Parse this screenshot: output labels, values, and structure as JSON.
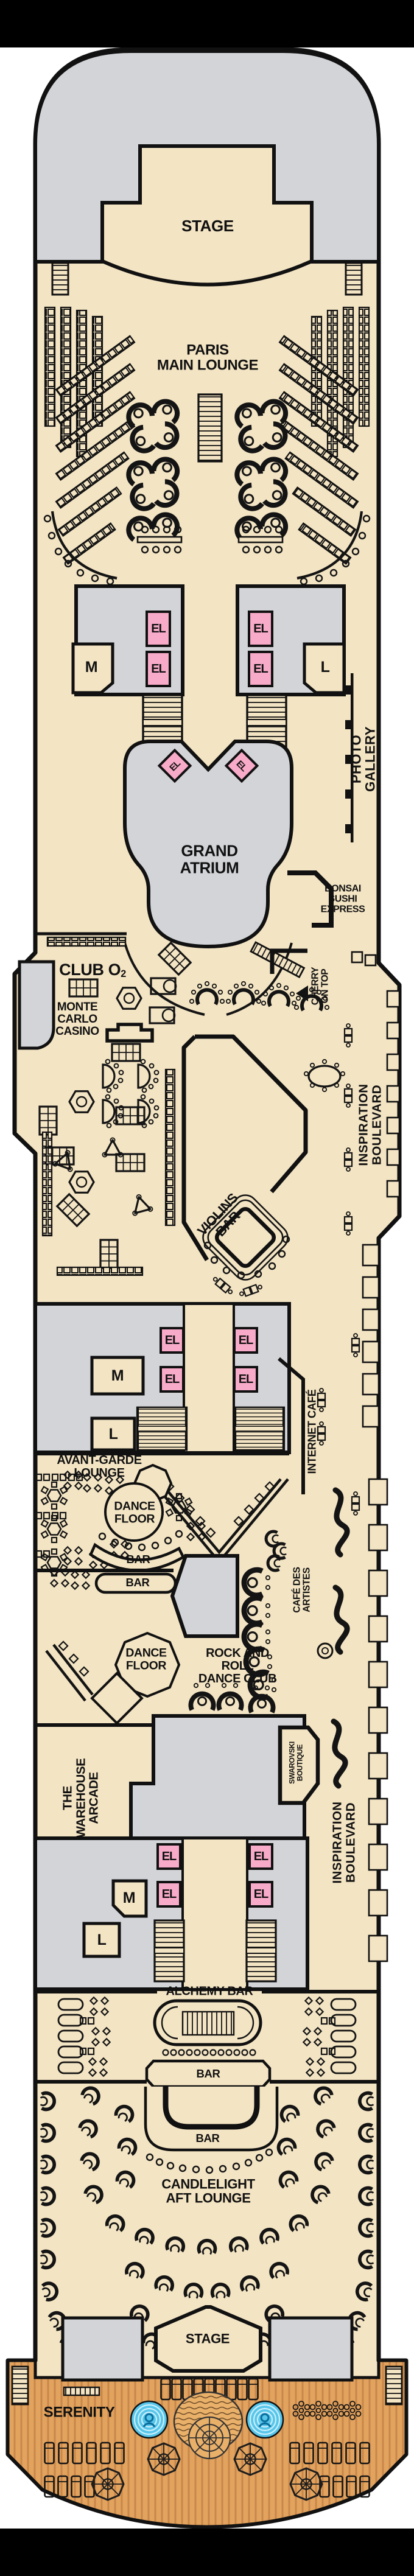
{
  "labels": {
    "stage_fwd": "STAGE",
    "paris": "PARIS\nMAIN LOUNGE",
    "grand_atrium": "GRAND\nATRIUM",
    "photo_gallery": "PHOTO GALLERY",
    "bonsai": "BONSAI\nSUSHI\nEXPRESS",
    "club_o2_main": "CLUB O",
    "club_o2_sub": "2",
    "cherry_on_top": "CHERRY\nON TOP",
    "monte_carlo": "MONTE\nCARLO\nCASINO",
    "violins_bar": "VIOLINS\nBAR",
    "inspiration_blvd": "INSPIRATION BOULEVARD",
    "internet_cafe": "INTERNET CAFÉ",
    "avant_garde": "AVANT-GARDE\nLOUNGE",
    "dance_floor": "DANCE\nFLOOR",
    "bar": "BAR",
    "cafe_des_artistes": "CAFÉ DES\nARTISTES",
    "rock_and_roll": "ROCK AND\nROLL\nDANCE CLUB",
    "warehouse": "THE\nWAREHOUSE\nARCADE",
    "swarovski": "SWAROVSKI\nBOUTIQUE",
    "alchemy": "ALCHEMY BAR",
    "candlelight": "CANDLELIGHT\nAFT LOUNGE",
    "stage_aft": "STAGE",
    "serenity": "SERENITY",
    "elevator": "EL",
    "mens": "M",
    "ladies": "L"
  },
  "colors": {
    "deck_beige": "#f3e4c3",
    "forward_gray": "#d2d4d8",
    "elevator_pink": "#f8abc8",
    "wood": "#e2a35e",
    "pool_blue": "#56c6ea",
    "outline": "#111111"
  }
}
